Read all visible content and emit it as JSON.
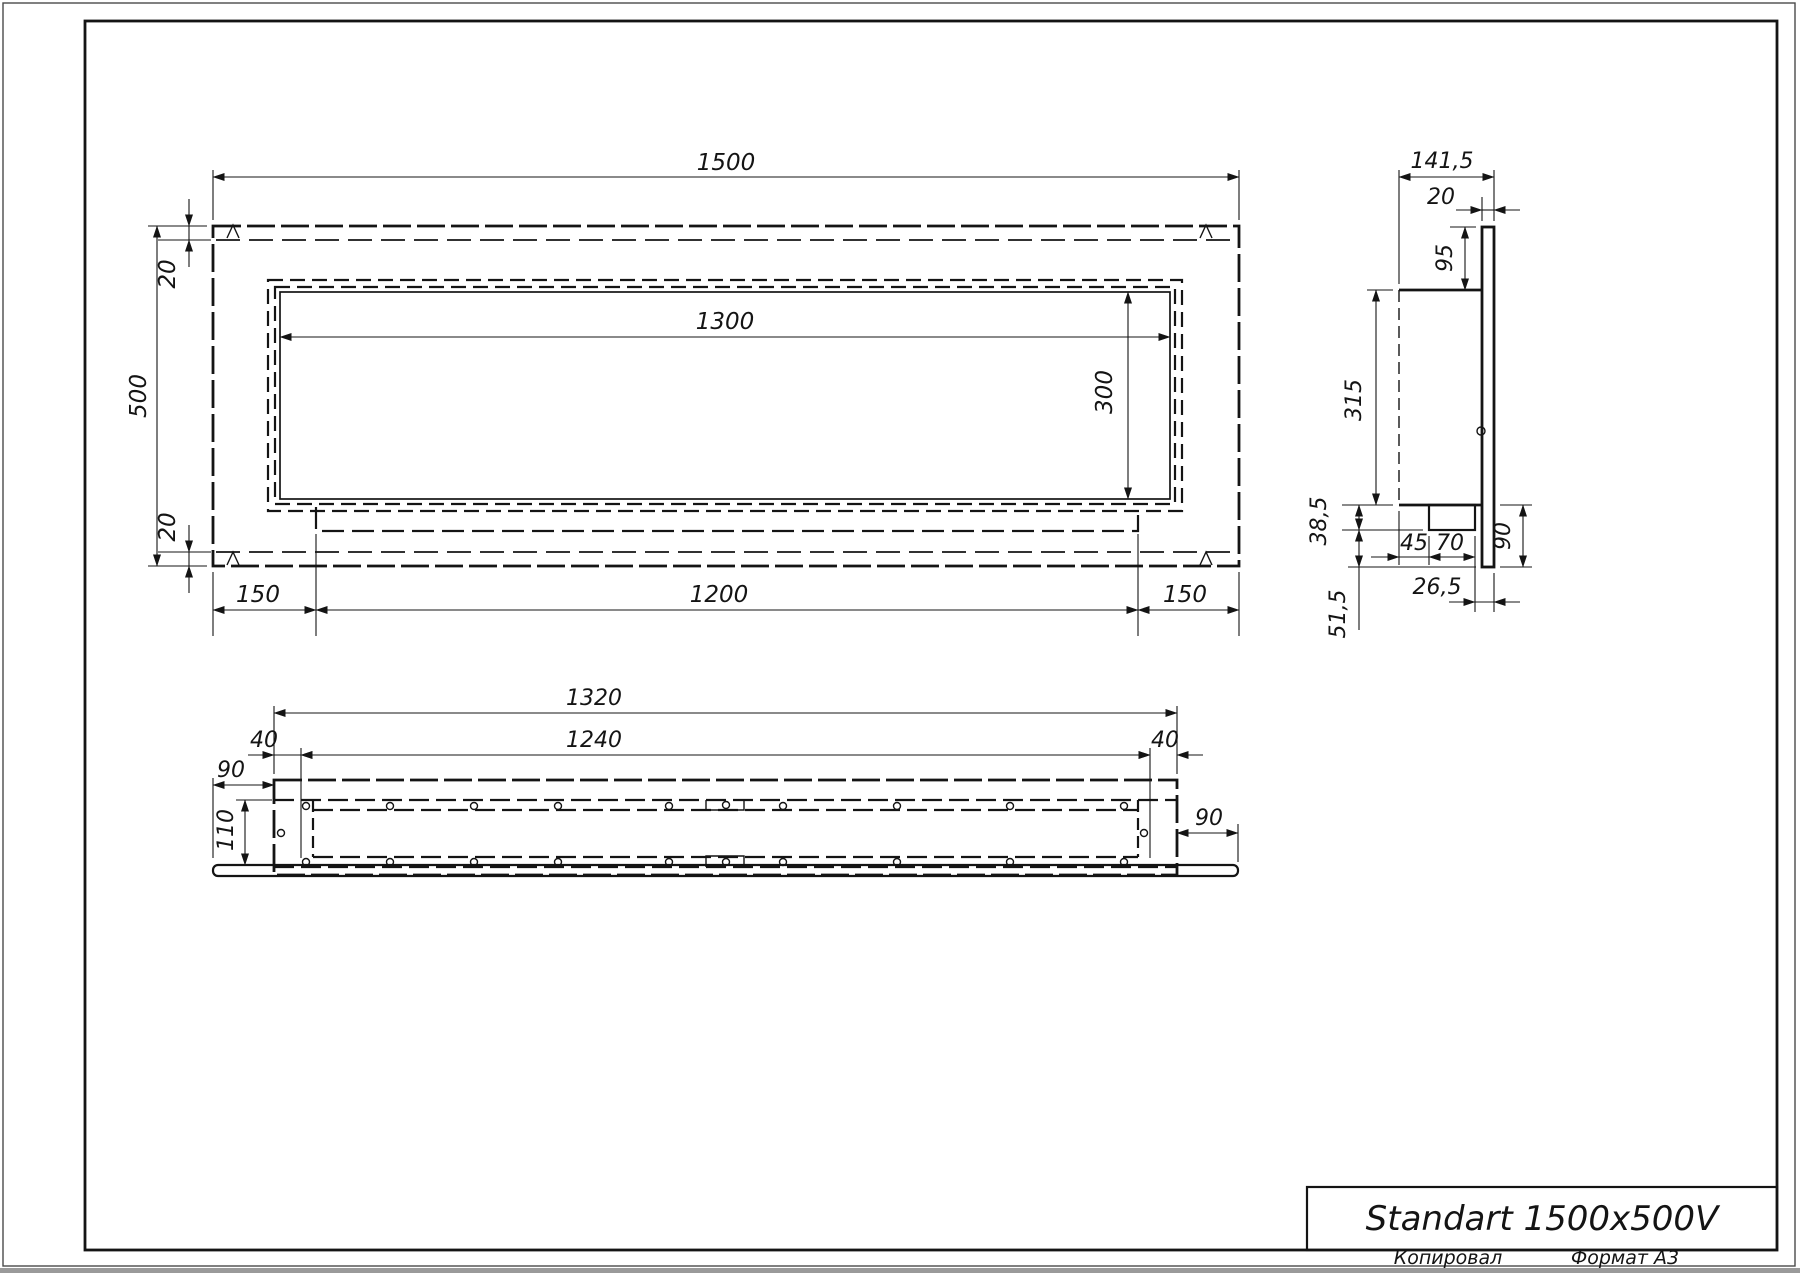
{
  "colors": {
    "ink": "#141414",
    "paper": "#ffffff"
  },
  "title_block": {
    "title": "Standart 1500x500V",
    "copied": "Копировал",
    "format": "Формат А3"
  },
  "front_view": {
    "overall_width": "1500",
    "overall_height": "500",
    "flange_top": "20",
    "flange_bottom": "20",
    "opening_width": "1300",
    "opening_height": "300",
    "margin_left": "150",
    "tray_width": "1200",
    "margin_right": "150"
  },
  "side_view": {
    "depth": "141,5",
    "face_thickness": "20",
    "top_offset": "95",
    "body_height": "315",
    "step_height": "38,5",
    "ledge_width": "45",
    "channel_width": "70",
    "lower_height": "90",
    "channel_offset": "26,5",
    "lower_offset": "51,5"
  },
  "bottom_view": {
    "body_length": "1320",
    "opening_length": "1240",
    "inset_left": "40",
    "inset_right": "40",
    "flange_left": "90",
    "flange_right": "90",
    "depth": "110"
  }
}
